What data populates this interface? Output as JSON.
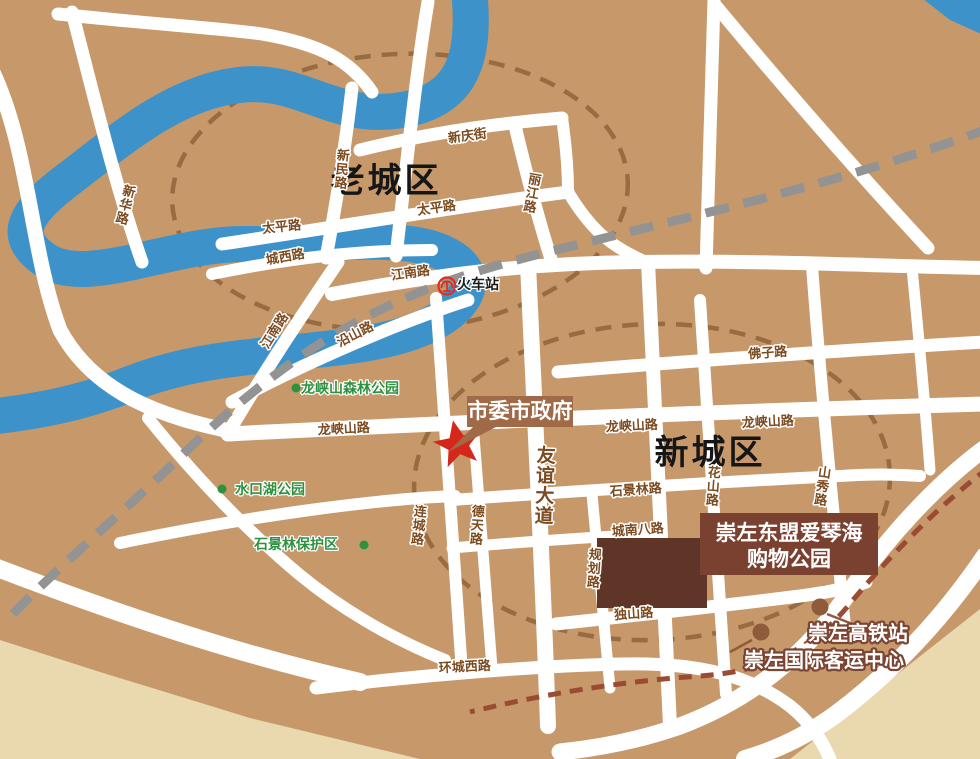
{
  "map": {
    "districts": {
      "old": "老城区",
      "new": "新城区"
    },
    "roads": {
      "xinhua": "新华路",
      "xinmin": "新民路",
      "xinqing_st": "新庆街",
      "taiping_e": "太平路",
      "taiping_w": "太平路",
      "chengxi": "城西路",
      "jiangnan_h": "江南路",
      "jiangnan_v": "江南路",
      "lijiang": "丽江路",
      "yanshan": "沿山路",
      "longxiashan_w": "龙峡山路",
      "longxiashan_c": "龙峡山路",
      "longxiashan_e": "龙峡山路",
      "fozi": "佛子路",
      "youyi_ave": "友谊大道",
      "detian": "德天路",
      "liancheng": "连城路",
      "huashan": "花山路",
      "shanxiu": "山秀路",
      "shijinglin": "石景林路",
      "chengnan8": "城南八路",
      "guihua": "规划路",
      "dushan": "独山路",
      "huancheng_w": "环城西路"
    },
    "parks": [
      {
        "name": "龙峡山森林公园"
      },
      {
        "name": "水口湖公园"
      },
      {
        "name": "石景林保护区"
      }
    ],
    "pois": {
      "train_station": "火车站",
      "government": "市委市政府",
      "shopping_line1": "崇左东盟爱琴海",
      "shopping_line2": "购物公园",
      "hsr_station": "崇左高铁站",
      "passenger_center": "崇左国际客运中心"
    },
    "colors": {
      "land": "#C6986A",
      "land_light": "#EAD8AE",
      "river": "#3D93C9",
      "road": "#FFFFFF",
      "railway": "#939393",
      "hsr_line": "#9B4B33",
      "zone_ellipse": "#96683F",
      "road_label": "#7C4A1F",
      "park_green": "#2E9140",
      "star_red": "#D6281A",
      "callout_bg": "#A06A48",
      "shopping_bg": "#7A4130",
      "building": "#5E3526",
      "poi_marker": "#8E5C3B",
      "train_logo_red": "#E02D1E"
    }
  }
}
